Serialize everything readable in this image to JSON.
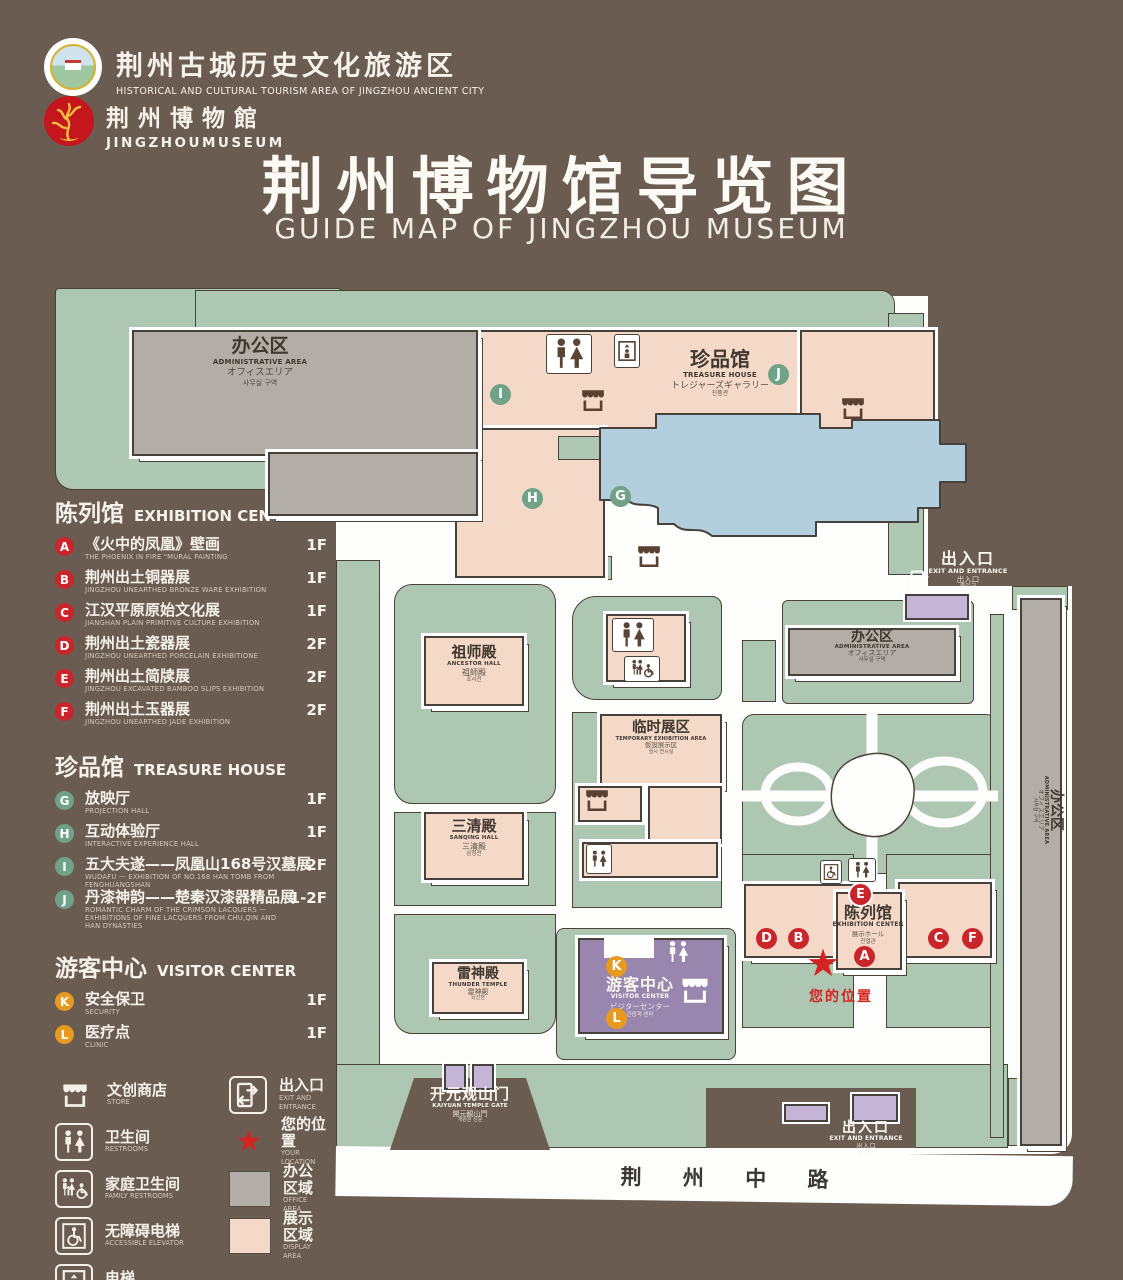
{
  "page": {
    "background": "#6a5c51"
  },
  "header": {
    "org_logo": {
      "cn": "荆州古城历史文化旅游区",
      "en": "HISTORICAL AND CULTURAL TOURISM AREA OF JINGZHOU ANCIENT CITY"
    },
    "museum_logo": {
      "cn": "荆州博物館",
      "en": "JINGZHOUMUSEUM"
    },
    "title": "荆州博物馆导览图",
    "subtitle": "GUIDE MAP OF JINGZHOU MUSEUM"
  },
  "legend": {
    "sections": [
      {
        "cn": "陈列馆",
        "en": "EXHIBITION CENTER",
        "items": [
          {
            "id": "A",
            "color": "red",
            "cn": "《火中的凤凰》壁画",
            "en": "THE PHOENIX IN FIRE \"MURAL PAINTING",
            "floor": "1F"
          },
          {
            "id": "B",
            "color": "red",
            "cn": "荆州出土铜器展",
            "en": "JINGZHOU UNEARTHED BRONZE WARE EXHIBITION",
            "floor": "1F"
          },
          {
            "id": "C",
            "color": "red",
            "cn": "江汉平原原始文化展",
            "en": "JIANGHAN PLAIN PRIMITIVE CULTURE EXHIBITION",
            "floor": "1F"
          },
          {
            "id": "D",
            "color": "red",
            "cn": "荆州出土瓷器展",
            "en": "JINGZHOU UNEARTHED PORCELAIN EXHIBITIONE",
            "floor": "2F"
          },
          {
            "id": "E",
            "color": "red",
            "cn": "荆州出土简牍展",
            "en": "JINGZHOU EXCAVATED BAMBOO SLIPS EXHIBITION",
            "floor": "2F"
          },
          {
            "id": "F",
            "color": "red",
            "cn": "荆州出土玉器展",
            "en": "JINGZHOU UNEARTHED JADE EXHIBITION",
            "floor": "2F"
          }
        ]
      },
      {
        "cn": "珍品馆",
        "en": "TREASURE HOUSE",
        "items": [
          {
            "id": "G",
            "color": "green",
            "cn": "放映厅",
            "en": "PROJECTION HALL",
            "floor": "1F"
          },
          {
            "id": "H",
            "color": "green",
            "cn": "互动体验厅",
            "en": "INTERACTIVE EXPERIENCE HALL",
            "floor": "1F"
          },
          {
            "id": "I",
            "color": "green",
            "cn": "五大夫遂——凤凰山168号汉墓展",
            "en": "WUDAFU — EXHIBITION OF NO.168 HAN TOMB FROM FENGHUANGSHAN",
            "floor": "2F"
          },
          {
            "id": "J",
            "color": "green",
            "cn": "丹漆神韵——楚秦汉漆器精品展",
            "en": "ROMANTIC CHARM OF THE CRIMSON LACQUERS — EXHIBITIONS OF FINE LACQUERS FROM CHU,QIN AND HAN DYNASTIES",
            "floor": "1-2F"
          }
        ]
      },
      {
        "cn": "游客中心",
        "en": "VISITOR CENTER",
        "items": [
          {
            "id": "K",
            "color": "orange",
            "cn": "安全保卫",
            "en": "SECURITY",
            "floor": "1F"
          },
          {
            "id": "L",
            "color": "orange",
            "cn": "医疗点",
            "en": "CLINIC",
            "floor": "1F"
          }
        ]
      }
    ],
    "icons": [
      {
        "icon": "store",
        "cn": "文创商店",
        "en": "STORE"
      },
      {
        "icon": "exit",
        "cn": "出入口",
        "en": "EXIT AND ENTRANCE"
      },
      {
        "icon": "restroom",
        "cn": "卫生间",
        "en": "RESTROOMS"
      },
      {
        "icon": "star",
        "cn": "您的位置",
        "en": "YOUR LOCATION"
      },
      {
        "icon": "family-restroom",
        "cn": "家庭卫生间",
        "en": "FAMILY RESTROOMS"
      },
      {
        "icon": "office-swatch",
        "cn": "办公区域",
        "en": "OFFICE AREA"
      },
      {
        "icon": "accessible-elevator",
        "cn": "无障碍电梯",
        "en": "ACCESSIBLE ELEVATOR"
      },
      {
        "icon": "display-swatch",
        "cn": "展示区域",
        "en": "DISPLAY AREA"
      },
      {
        "icon": "elevator",
        "cn": "电梯",
        "en": "Elevator"
      }
    ]
  },
  "map": {
    "labels": {
      "admin_nw": {
        "cn": "办公区",
        "en": "ADMINISTRATIVE AREA",
        "jp": "オフィスエリア",
        "kr": "사무실 구역"
      },
      "treasure_house": {
        "cn": "珍品馆",
        "en": "TREASURE HOUSE",
        "jp": "トレジャーズギャラリー",
        "kr": "진품관"
      },
      "ancestor_hall": {
        "cn": "祖师殿",
        "en": "ANCESTOR HALL",
        "jp": "祖師殿",
        "kr": "조사전"
      },
      "temporary_exhibition": {
        "cn": "临时展区",
        "en": "TEMPORARY EXHIBITION AREA",
        "jp": "仮設展示区",
        "kr": "임시 전시실"
      },
      "sanqing_hall": {
        "cn": "三清殿",
        "en": "SANQING HALL",
        "jp": "三清殿",
        "kr": "삼청전"
      },
      "thunder_temple": {
        "cn": "雷神殿",
        "en": "THUNDER TEMPLE",
        "jp": "雷神殿",
        "kr": "뇌신전"
      },
      "visitor_center": {
        "cn": "游客中心",
        "en": "VISITOR CENTER",
        "jp": "ビジターセンター",
        "kr": "관광객 센터"
      },
      "exhibition_center": {
        "cn": "陈列馆",
        "en": "EXHIBITION CENTER",
        "jp": "展示ホール",
        "kr": "진열관"
      },
      "admin_e": {
        "cn": "办公区",
        "en": "ADMINISTRATIVE AREA",
        "jp": "オフィスエリア",
        "kr": "사무실 구역"
      },
      "admin_strip": {
        "cn": "办公区",
        "en": "ADMINISTRATIVE AREA",
        "jp": "オフィスエリア",
        "kr": "사무실 구역"
      },
      "exit_ne": {
        "cn": "出入口",
        "en": "EXIT AND ENTRANCE",
        "jp": "出入口",
        "kr": "출입구"
      },
      "exit_se": {
        "cn": "出入口",
        "en": "EXIT AND ENTRANCE",
        "jp": "出入口",
        "kr": "출입구"
      },
      "gate": {
        "cn": "开元观山门",
        "en": "KAIYUAN TEMPLE GATE",
        "jp": "開元観山門",
        "kr": "개원관 산문"
      },
      "road": "荆 州 中 路",
      "your_location": "您的位置"
    },
    "marker_letters": {
      "A": "A",
      "B": "B",
      "C": "C",
      "D": "D",
      "E": "E",
      "F": "F",
      "G": "G",
      "H": "H",
      "I": "I",
      "J": "J",
      "K": "K",
      "L": "L"
    }
  },
  "colors": {
    "background": "#6a5c51",
    "lawn": "#aec7b3",
    "display_area": "#f5d9c8",
    "office_area": "#b2ada6",
    "lake": "#b3cedd",
    "visitor_purple": "#9886ae",
    "gate_purple": "#c4b5d6",
    "marker_red": "#c9252b",
    "marker_green": "#6fa287",
    "marker_orange": "#e8991f",
    "star_red": "#d42421"
  }
}
